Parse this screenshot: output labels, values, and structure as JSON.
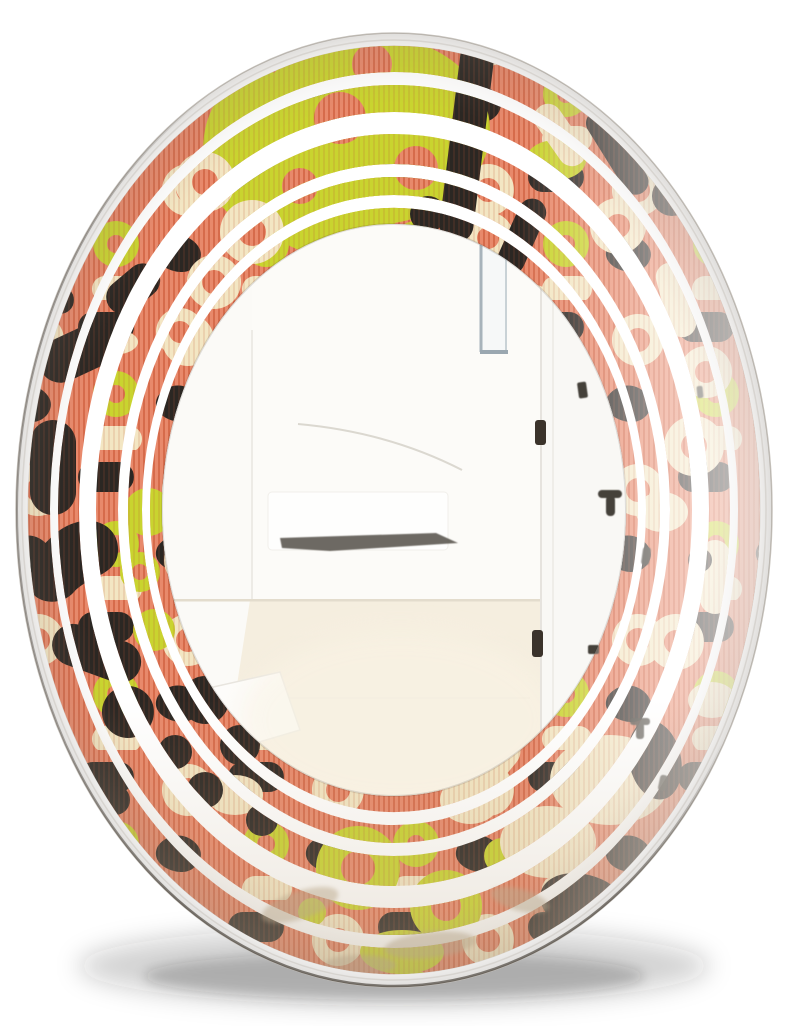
{
  "meta": {
    "description": "Product photograph of a decorative oval wall mirror with a retro mid-century pattern frame, shown hanging on a white wall reflecting a bright room interior",
    "background": "white studio wall"
  },
  "palette": {
    "coral": "#E8896B",
    "coralDark": "#DA6F4F",
    "ink": "#2B2723",
    "cream": "#F3E6C3",
    "chartreuse": "#C9D42F",
    "bevelWhite": "#FFFFFF",
    "rimGray": "#C8C4BE",
    "wall": "#FCFBF8",
    "floor": "#F5EEDF",
    "windowFrame": "#A7B3BB",
    "hinge": "#3B332B",
    "benchShadow": "#4A443C",
    "marble": "#BCA882",
    "shadow": "#282420"
  },
  "mirror": {
    "shape": "oval",
    "frame_style": "retro abstract pattern printed in five concentric oval bands separated by clear mirror stripes",
    "ring_count": 5,
    "pattern_motifs": [
      "striped coral ground",
      "black blobs and capsules",
      "cream chain rings",
      "chartreuse circles and donuts"
    ],
    "finish": "beveled white edge with soft drop shadow"
  },
  "reflection": {
    "scene": "bright white room seen through the mirror",
    "elements": [
      "open doorway with white walls",
      "window with thin gray frame",
      "open white door with dark hinges",
      "white bench with dark shadow underneath",
      "light wood floor",
      "small dark hinge reflections in the mirror stripes"
    ]
  }
}
